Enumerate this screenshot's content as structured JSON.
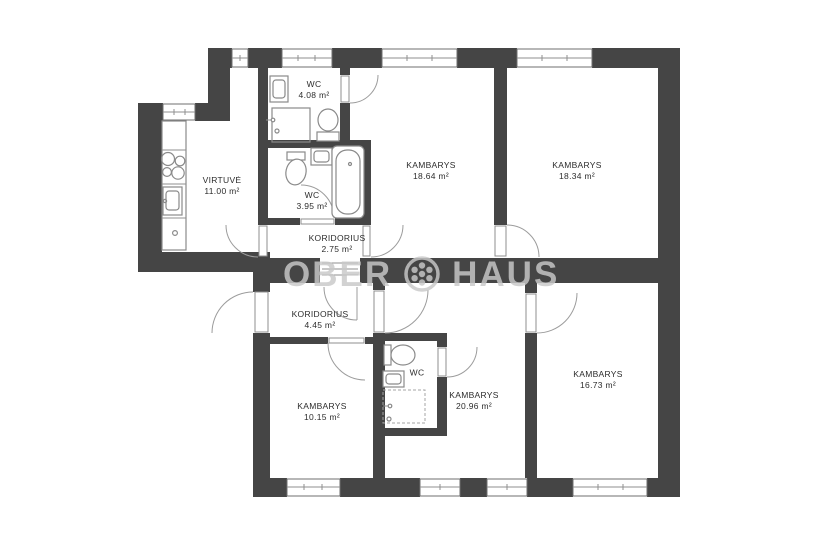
{
  "watermark": {
    "left": "OBER",
    "right": "HAUS"
  },
  "colors": {
    "wall": "#454545",
    "line": "#8f8f8f",
    "label": "#2d2d2d",
    "watermark": "#c9c9c9"
  },
  "rooms": [
    {
      "id": "virtuve",
      "name": "VIRTUVĖ",
      "area": "11.00 m²"
    },
    {
      "id": "wc-top",
      "name": "WC",
      "area": "4.08 m²"
    },
    {
      "id": "wc-middle",
      "name": "WC",
      "area": "3.95 m²"
    },
    {
      "id": "koridorius-1",
      "name": "KORIDORIUS",
      "area": "2.75 m²"
    },
    {
      "id": "kambarys-1",
      "name": "KAMBARYS",
      "area": "18.64 m²"
    },
    {
      "id": "kambarys-2",
      "name": "KAMBARYS",
      "area": "18.34 m²"
    },
    {
      "id": "koridorius-2",
      "name": "KORIDORIUS",
      "area": "4.45 m²"
    },
    {
      "id": "kambarys-3",
      "name": "KAMBARYS",
      "area": "10.15 m²"
    },
    {
      "id": "wc-bottom",
      "name": "WC",
      "area": ""
    },
    {
      "id": "kambarys-4",
      "name": "KAMBARYS",
      "area": "20.96 m²"
    },
    {
      "id": "kambarys-5",
      "name": "KAMBARYS",
      "area": "16.73 m²"
    }
  ]
}
